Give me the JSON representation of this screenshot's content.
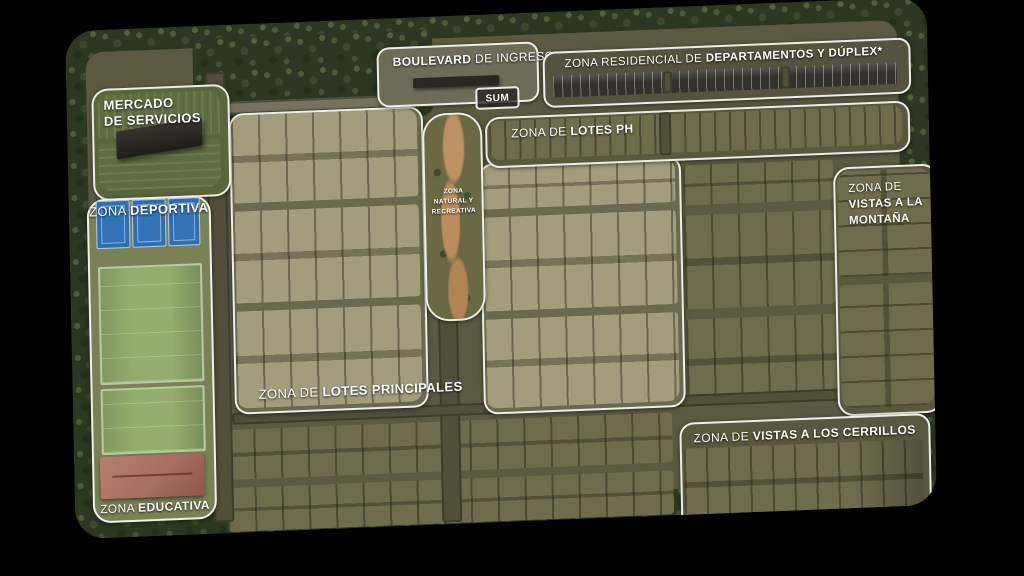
{
  "colors": {
    "background": "#000000",
    "zone_outline": "#f8f7f2",
    "trees": "#2c3621",
    "lot_light": "#a39d7e",
    "lot_dark": "#6f6c4d",
    "road": "#514e3a",
    "court_blue": "#3273b8",
    "field_green": "#93ad6d",
    "school_roof": "#a86f60",
    "label_text": "#ffffff"
  },
  "zones": {
    "mercado": {
      "line1": "MERCADO",
      "line2": "DE SERVICIOS"
    },
    "deportiva": {
      "prefix": "ZONA ",
      "name": "DEPORTIVA"
    },
    "educativa": {
      "prefix": "ZONA ",
      "name": "EDUCATIVA"
    },
    "boulevard": {
      "name": "BOULEVARD",
      "suffix": " DE INGRESO"
    },
    "sum": {
      "name": "SUM"
    },
    "residencial": {
      "prefix": "ZONA RESIDENCIAL DE ",
      "name": "DEPARTAMENTOS Y DÚPLEX*"
    },
    "lotes_ph": {
      "prefix": "ZONA DE ",
      "name": "LOTES PH"
    },
    "natural": {
      "line1": "ZONA",
      "line2": "NATURAL Y",
      "line3": "RECREATIVA"
    },
    "montana": {
      "prefix": "ZONA DE",
      "line1": "VISTAS A LA",
      "line2": "MONTAÑA"
    },
    "principales": {
      "prefix": "ZONA DE ",
      "name": "LOTES PRINCIPALES"
    },
    "cerrillos": {
      "prefix": "ZONA DE ",
      "name": "VISTAS A LOS CERRILLOS"
    }
  }
}
